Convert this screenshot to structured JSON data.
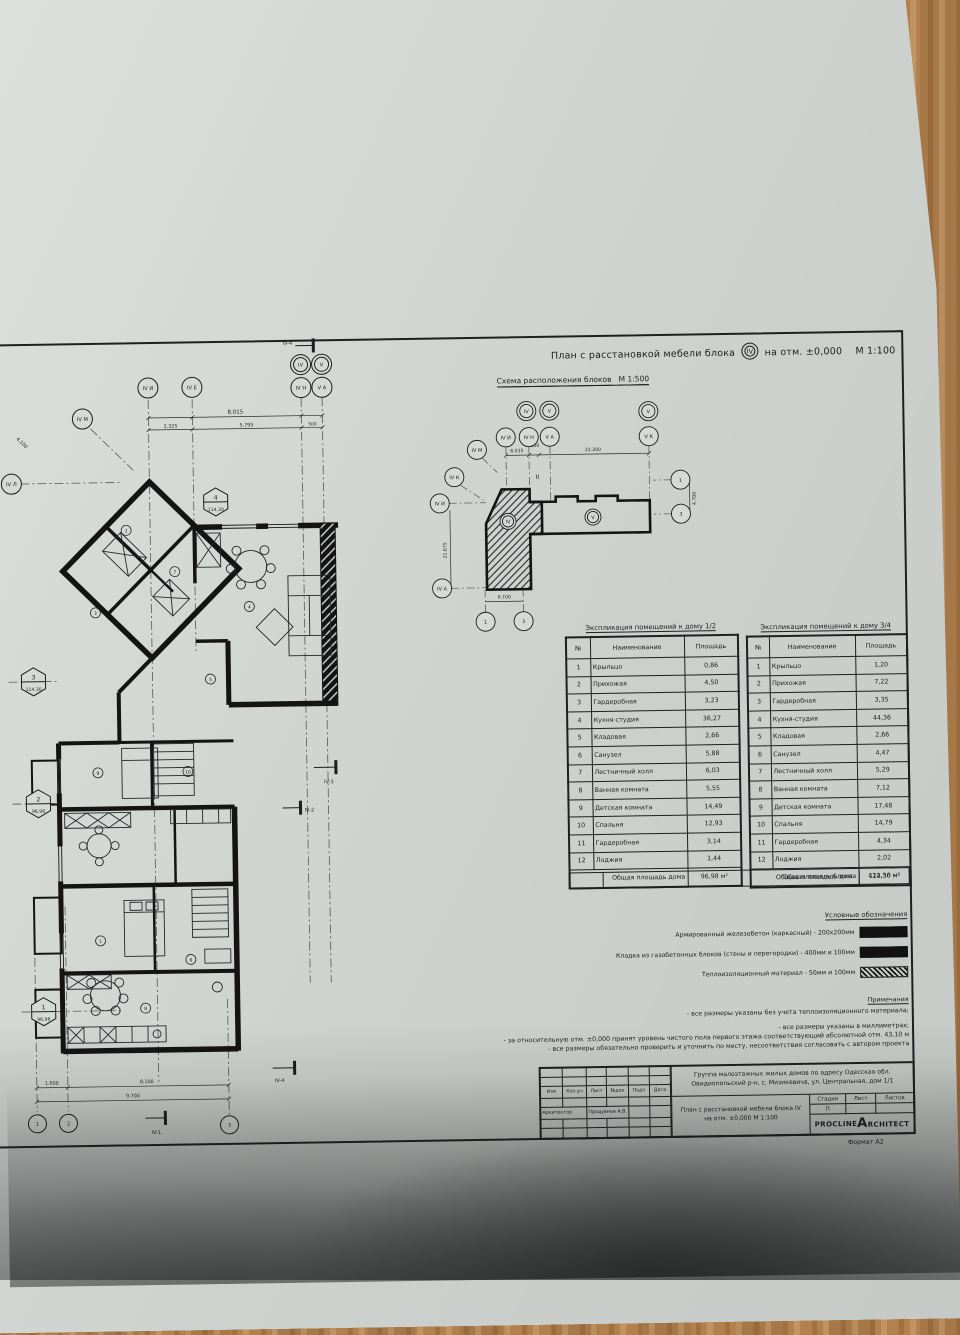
{
  "sheet": {
    "top_title": "План с расстановкой мебели блока",
    "top_title_block": "IV",
    "top_title_rest": "на отм. ±0,000",
    "top_title_scale": "М 1:100",
    "format_note": "Формат А2"
  },
  "scheme": {
    "title": "Схема расположения блоков",
    "scale": "М 1:500",
    "block_iv_label": "IV",
    "block_v_label": "V",
    "axes": {
      "top_iv": "IV",
      "top_v": "V",
      "right_v": "V",
      "iv_i": "IV И",
      "iv_n": "IV Н",
      "v_a": "V А",
      "v_k": "V К",
      "iv_m": "IV М",
      "iv_k": "IV К",
      "iv_i2": "IV И",
      "iv_a": "IV А",
      "r1": "1",
      "r3": "3",
      "b1": "1",
      "b3": "3",
      "ii": "II"
    },
    "dims": {
      "top_left": "6.015",
      "top_mid": "500",
      "top_right": "22.200",
      "left": "21.675",
      "bottom": "9.700",
      "right": "4.700"
    }
  },
  "explication_left": {
    "title": "Экспликация помещений к дому 1/2",
    "headers": [
      "№",
      "Наименование",
      "Площадь"
    ],
    "rows": [
      [
        "1",
        "Крыльцо",
        "0,86"
      ],
      [
        "2",
        "Прихожая",
        "4,50"
      ],
      [
        "3",
        "Гардеробная",
        "3,23"
      ],
      [
        "4",
        "Кухня-студия",
        "36,27"
      ],
      [
        "5",
        "Кладовая",
        "2,66"
      ],
      [
        "6",
        "Санузел",
        "5,88"
      ],
      [
        "7",
        "Лестничный холл",
        "6,03"
      ],
      [
        "8",
        "Ванная комната",
        "5,55"
      ],
      [
        "9",
        "Детская комната",
        "14,49"
      ],
      [
        "10",
        "Спальня",
        "12,93"
      ],
      [
        "11",
        "Гардеробная",
        "3,14"
      ],
      [
        "12",
        "Лоджия",
        "1,44"
      ]
    ],
    "total_label": "Общая площадь дома",
    "total_value": "96,98 м²"
  },
  "explication_right": {
    "title": "Экспликация помещений к дому 3/4",
    "headers": [
      "№",
      "Наименование",
      "Площадь"
    ],
    "rows": [
      [
        "1",
        "Крыльцо",
        "1,20"
      ],
      [
        "2",
        "Прихожая",
        "7,22"
      ],
      [
        "3",
        "Гардеробная",
        "3,35"
      ],
      [
        "4",
        "Кухня-студия",
        "44,36"
      ],
      [
        "5",
        "Кладовая",
        "2,66"
      ],
      [
        "6",
        "Санузел",
        "4,47"
      ],
      [
        "7",
        "Лестничный холл",
        "5,29"
      ],
      [
        "8",
        "Ванная комната",
        "7,12"
      ],
      [
        "9",
        "Детская комната",
        "17,48"
      ],
      [
        "10",
        "Спальня",
        "14,79"
      ],
      [
        "11",
        "Гардеробная",
        "4,34"
      ],
      [
        "12",
        "Лоджия",
        "2,02"
      ]
    ],
    "total_label": "Общая площадь дома",
    "total_value": "114,30 м²"
  },
  "block_total": {
    "label": "Общая площадь блока",
    "value": "422,56 м²"
  },
  "legend": {
    "title": "Условные обозначения",
    "items": [
      {
        "label": "Армированный железобетон (каркасный) - 200х200мм"
      },
      {
        "label": "Кладка из газобетонных блоков (стены и перегородки) - 400мм и 100мм"
      },
      {
        "label": "Теплоизоляционный материал - 50мм и 100мм"
      }
    ]
  },
  "notes": {
    "title": "Примечания",
    "lines": [
      "- все размеры указаны без учета теплоизоляционного материала;",
      "- все размеры указаны в миллиметрах;",
      "- за относительную отм. ±0,000 принят уровень чистого пола первого этажа соответствующий абсолютной отм. 43,10 м",
      "- все размеры обязательно проверить и уточнить по месту, несоответствия согласовать с автором проекта"
    ]
  },
  "stamp": {
    "address_line1": "Группа малоэтажных жилых домов по адресу Одесская обл.",
    "address_line2": "Овидиопольский р-н, с. Мизикевича, ул. Центральная, дом 1/1",
    "columns": [
      "Изм",
      "Кол.уч",
      "Лист",
      "№док",
      "Подп",
      "Дата"
    ],
    "role": "Архитектор",
    "name": "Продувнов А.В.",
    "drawing_title_1": "План с расстановкой мебели блока  IV",
    "drawing_title_2": "на отм. ±0,000   М 1:100",
    "stage_label": "Стадия",
    "sheet_label": "Лист",
    "sheets_label": "Листов",
    "stage_value": "П",
    "logo_left": "PROCLINE",
    "logo_right": "ARCHITECT"
  },
  "plan": {
    "axis": {
      "iv_i": "IV И",
      "iv_e": "IV Е",
      "iv": "IV",
      "v": "V",
      "iv_n": "IV Н",
      "v_a": "V А",
      "iv_m": "IV М",
      "iv_l": "IV Л",
      "b1": "1",
      "b2": "2",
      "b3": "3"
    },
    "sections": {
      "s1": "IV-1",
      "s2": "IV-2",
      "s3": "IV-3",
      "s4": "IV-4",
      "s4b": "IV-4"
    },
    "tags": [
      {
        "n": "4",
        "a": "114,30"
      },
      {
        "n": "3",
        "a": "114,30"
      },
      {
        "n": "2",
        "a": "96,98"
      },
      {
        "n": "1",
        "a": "96,98"
      }
    ],
    "dims": {
      "top_total": "8.015",
      "t1": "2.325",
      "t2": "5.795",
      "t3": "500",
      "diag": "4.100",
      "b1": "1.600",
      "b2": "8.100",
      "b3": "9.700"
    },
    "room_markers": [
      "1",
      "2",
      "3",
      "4",
      "5",
      "6",
      "7",
      "8",
      "9",
      "10"
    ]
  }
}
